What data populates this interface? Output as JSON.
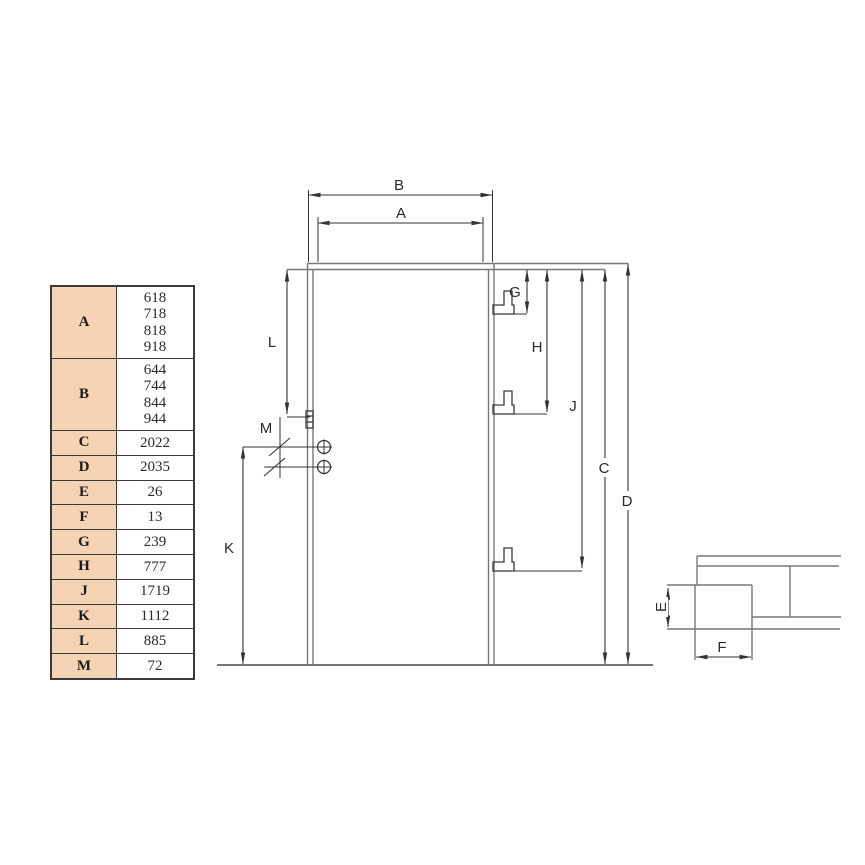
{
  "page": {
    "background": "#ffffff"
  },
  "table": {
    "key_bg": "#f5d3b4",
    "border_color": "#3a3a3a",
    "rows": [
      {
        "key": "A",
        "value": "618\n718\n818\n918"
      },
      {
        "key": "B",
        "value": "644\n744\n844\n944"
      },
      {
        "key": "C",
        "value": "2022"
      },
      {
        "key": "D",
        "value": "2035"
      },
      {
        "key": "E",
        "value": "26"
      },
      {
        "key": "F",
        "value": "13"
      },
      {
        "key": "G",
        "value": "239"
      },
      {
        "key": "H",
        "value": "777"
      },
      {
        "key": "J",
        "value": "1719"
      },
      {
        "key": "K",
        "value": "1112"
      },
      {
        "key": "L",
        "value": "885"
      },
      {
        "key": "M",
        "value": "72"
      }
    ]
  },
  "drawing": {
    "outline_color": "#777777",
    "dimension_color": "#333333",
    "labels": {
      "A": "A",
      "B": "B",
      "C": "C",
      "D": "D",
      "E": "E",
      "F": "F",
      "G": "G",
      "H": "H",
      "J": "J",
      "K": "K",
      "L": "L",
      "M": "M"
    }
  }
}
